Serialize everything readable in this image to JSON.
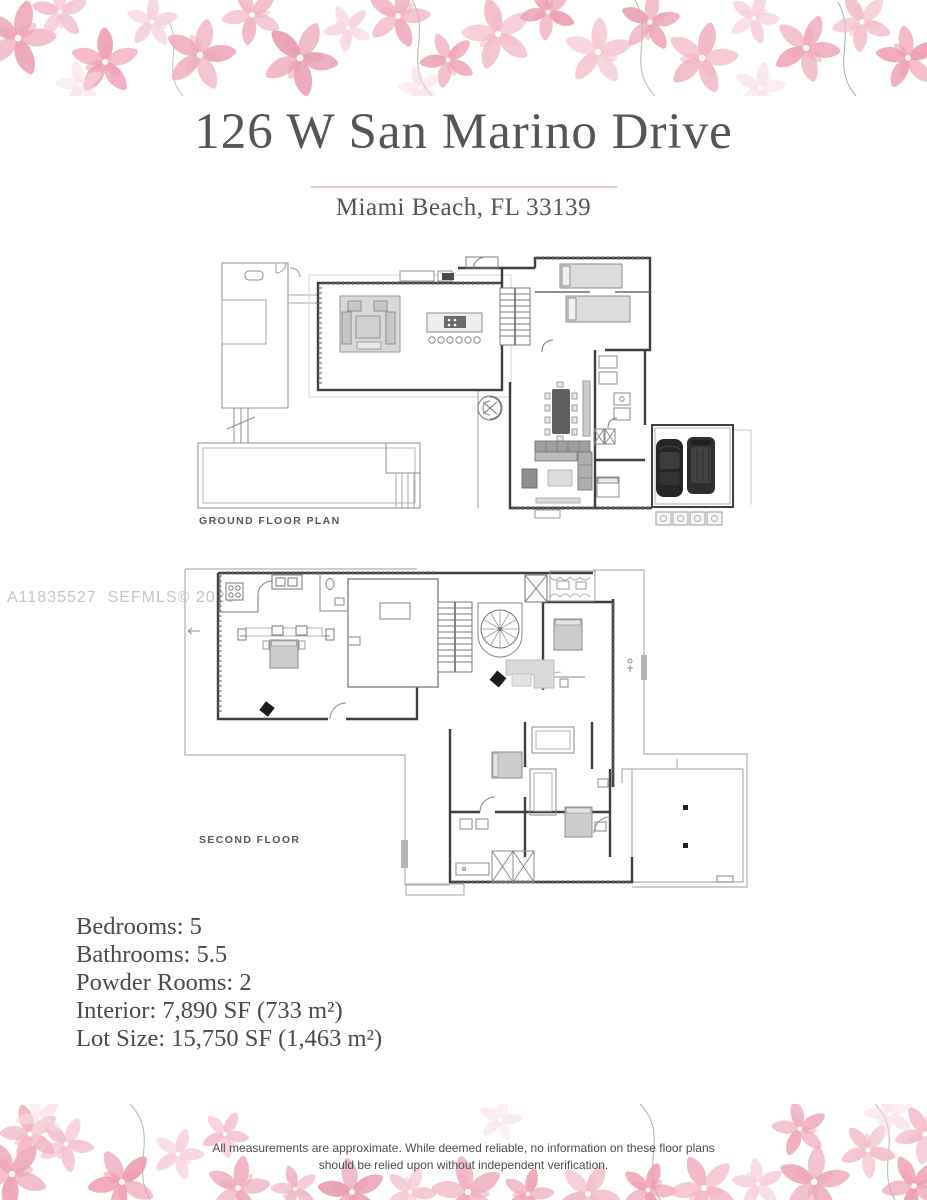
{
  "header": {
    "title": "126 W San Marino Drive",
    "subtitle": "Miami Beach, FL 33139"
  },
  "watermark": "A11835527  SEFMLS© 2026",
  "floor_plans": {
    "ground": {
      "label": "GROUND FLOOR PLAN"
    },
    "second": {
      "label": "SECOND FLOOR"
    }
  },
  "details": {
    "lines": [
      "Bedrooms: 5",
      "Bathrooms: 5.5",
      "Powder Rooms: 2",
      "Interior: 7,890 SF (733 m²)",
      "Lot Size: 15,750 SF (1,463 m²)"
    ]
  },
  "footer": {
    "disclaimer_line1": "All measurements are approximate. While deemed reliable, no information on these floor plans",
    "disclaimer_line2": "should be relied upon without independent verification."
  },
  "colors": {
    "petal_pink_mid": "#eda7ba",
    "petal_pink_light": "#f4c4d1",
    "petal_pink_deep": "#e897ad",
    "divider_pink": "#e7c9cd",
    "text_gray": "#4c4c4c",
    "plan_wall": "#3f3f3f",
    "watermark_gray": "#c5c5c5"
  }
}
